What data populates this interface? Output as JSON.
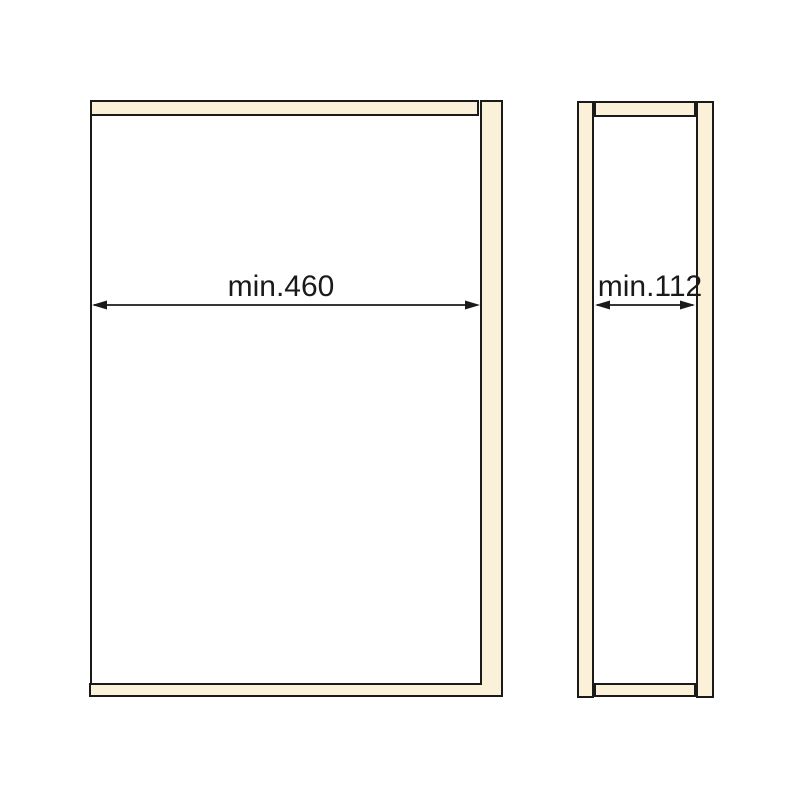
{
  "page": {
    "background_color": "#FFFFFF"
  },
  "drawing": {
    "type": "cabinet-dimension-diagram",
    "outline_color": "#1A1A1A",
    "panel_fill_color": "#FAF1D8",
    "views": {
      "front": {
        "dimension_label": "min.460"
      },
      "side": {
        "dimension_label": "min.112"
      }
    }
  }
}
